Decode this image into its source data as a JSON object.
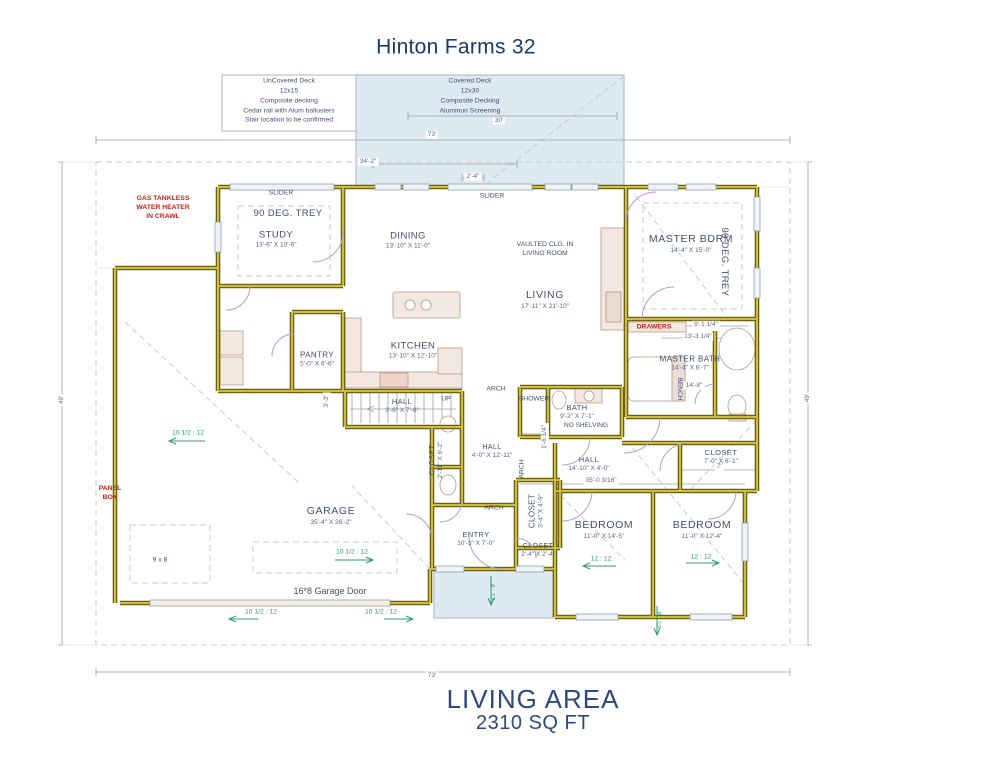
{
  "title": "Hinton Farms 32",
  "decks": {
    "uncovered": {
      "lines": [
        "UnCovered Deck",
        "12x15",
        "Composite decking",
        "Cedar rail with Alum ballusters",
        "Stair location to be confirmed"
      ]
    },
    "covered": {
      "lines": [
        "Covered Deck",
        "12x30",
        "Composite Decking",
        "Aluminun Screening"
      ]
    }
  },
  "rooms": {
    "study": {
      "name": "STUDY",
      "dims": "13'-6\" X 10'-6\""
    },
    "dining": {
      "name": "DINING",
      "dims": "13'-10\" X 11'-0\""
    },
    "living": {
      "name": "LIVING",
      "dims": "17'-11\" X 21'-10\""
    },
    "master_bdrm": {
      "name": "MASTER BDRM",
      "dims": "14'-4\" X 15'-0\""
    },
    "kitchen": {
      "name": "KITCHEN",
      "dims": "13'-10\" X 12'-10\""
    },
    "pantry": {
      "name": "PANTRY",
      "dims": "5'-0\" X 6'-6\""
    },
    "hall_stairs": {
      "name": "HALL",
      "dims": "3'-6\" X 7'-6\""
    },
    "master_bath": {
      "name": "MASTER BATH",
      "dims": "14'-4\" X 6'-7\""
    },
    "bath": {
      "name": "BATH",
      "dims": "9'-2\" X 7'-1\""
    },
    "hall_mid": {
      "name": "HALL",
      "dims": "14'-10\" X 4'-0\""
    },
    "closet_right": {
      "name": "CLOSET",
      "dims": "7'-0\" X 6'-1\""
    },
    "closet_hall": {
      "name": "CLOSET",
      "dims": "2'-11\" X 6'-2\""
    },
    "hall_entry": {
      "name": "HALL",
      "dims": "4'-0\" X 12'-11\""
    },
    "closet_arch": {
      "name": "CLOSET",
      "dims": "3'-4\" X 4'-9\""
    },
    "garage": {
      "name": "GARAGE",
      "dims": "35'-4\" X 26'-2\""
    },
    "entry": {
      "name": "ENTRY",
      "dims": "10'-3\" X 7'-0\""
    },
    "closet_entry": {
      "name": "CLOSET",
      "dims": "2'-4\" X 2'-4\""
    },
    "bedroom1": {
      "name": "BEDROOM",
      "dims": "11'-0\" X 14'-5\""
    },
    "bedroom2": {
      "name": "BEDROOM",
      "dims": "11'-0\" X 12'-4\""
    }
  },
  "annotations": {
    "slider_left": "SLIDER",
    "slider_right": "SLIDER",
    "trey_study": "90 DEG. TREY",
    "trey_master": "90 DEG. TREY",
    "gas_lines": [
      "GAS TANKLESS",
      "WATER HEATER",
      "IN CRAWL"
    ],
    "panel_lines": [
      "PANEL",
      "BOX"
    ],
    "drawers": "DRAWERS",
    "no_shelving": "NO SHELVING",
    "bench": "BENCH",
    "up": "UP",
    "arch_top": "ARCH",
    "arch_mid": "ARCH",
    "arch_lower": "ARCH",
    "vaulted_lines": [
      "VAULTED CLG. IN",
      "LIVING ROOM"
    ],
    "storage": "9 x 8",
    "garage_door": "16*8 Garage Door"
  },
  "pitches": {
    "garage_left": "10 1/2 : 12",
    "garage_center": "10 1/2 : 12",
    "front_left": "10 1/2 : 12",
    "front_right": "10 1/2 : 12",
    "bedroom1": "12 : 12",
    "bedroom2": "12 : 12",
    "porch": "4 : 12",
    "rear_right": "8 : 12"
  },
  "dimensions": {
    "overall_top": "73'",
    "deck_covered": "30'",
    "house_left": "34'-2\"",
    "offset": "2'-4\"",
    "overall_bottom": "73'",
    "depth_left": "49'",
    "depth_right": "49'",
    "master_a": "9'-1 1/4\"",
    "master_b": "13'-3 1/4\"",
    "master_bath_w": "14'-8\"",
    "hall_run": "35'-0 3/16\"",
    "closet_w": "7'",
    "shower_w": "1'-6 1/4\"",
    "stair_w": "3'-3\""
  },
  "footer": {
    "label": "LIVING AREA",
    "value": "2310 SQ FT"
  },
  "colors": {
    "accent_blue": "#1b3a66",
    "annotation_red": "#c2271d",
    "pitch_green": "#2f9e68",
    "wall_gold": "#cdbb45",
    "deck_blue": "#ddeaf2"
  }
}
